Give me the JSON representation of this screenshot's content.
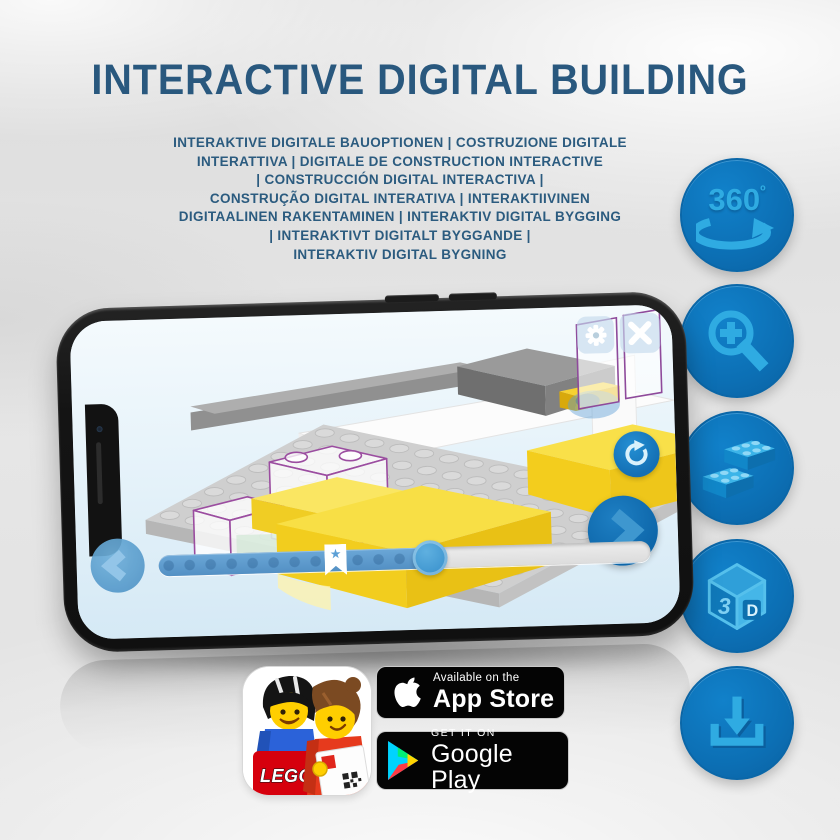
{
  "header": {
    "title": "INTERACTIVE DIGITAL BUILDING"
  },
  "subtitle": {
    "lines": [
      "INTERAKTIVE DIGITALE BAUOPTIONEN | COSTRUZIONE DIGITALE",
      "INTERATTIVA | DIGITALE DE CONSTRUCTION INTERACTIVE",
      "| CONSTRUCCIÓN DIGITAL INTERACTIVA |",
      "CONSTRUÇÃO DIGITAL INTERATIVA | INTERAKTIIVINEN",
      "DIGITAALINEN RAKENTAMINEN | INTERAKTIV DIGITAL BYGGING",
      "| INTERAKTIVT DIGITALT BYGGANDE |",
      "INTERAKTIV DIGITAL BYGNING"
    ]
  },
  "side_icons": {
    "items": [
      {
        "id": "rotate-360",
        "label": "360",
        "degree": "º"
      },
      {
        "id": "zoom-in"
      },
      {
        "id": "bricks"
      },
      {
        "id": "cube-3d",
        "face_left": "3",
        "face_right": "D"
      },
      {
        "id": "download"
      }
    ],
    "circle_color": "#0c6fb4",
    "glyph_color": "#2fabe2"
  },
  "badges": {
    "app_store": {
      "line1": "Available on the",
      "line2": "App Store"
    },
    "google_play": {
      "line1": "GET IT ON",
      "line2": "Google Play"
    }
  },
  "app_icon": {
    "lego_logo_text": "LEGO"
  },
  "colors": {
    "headline_blue": "#29587e",
    "button_blue": "#0c6fb4",
    "glyph_blue": "#2fabe2",
    "highlight_yellow": "#f8df45"
  }
}
